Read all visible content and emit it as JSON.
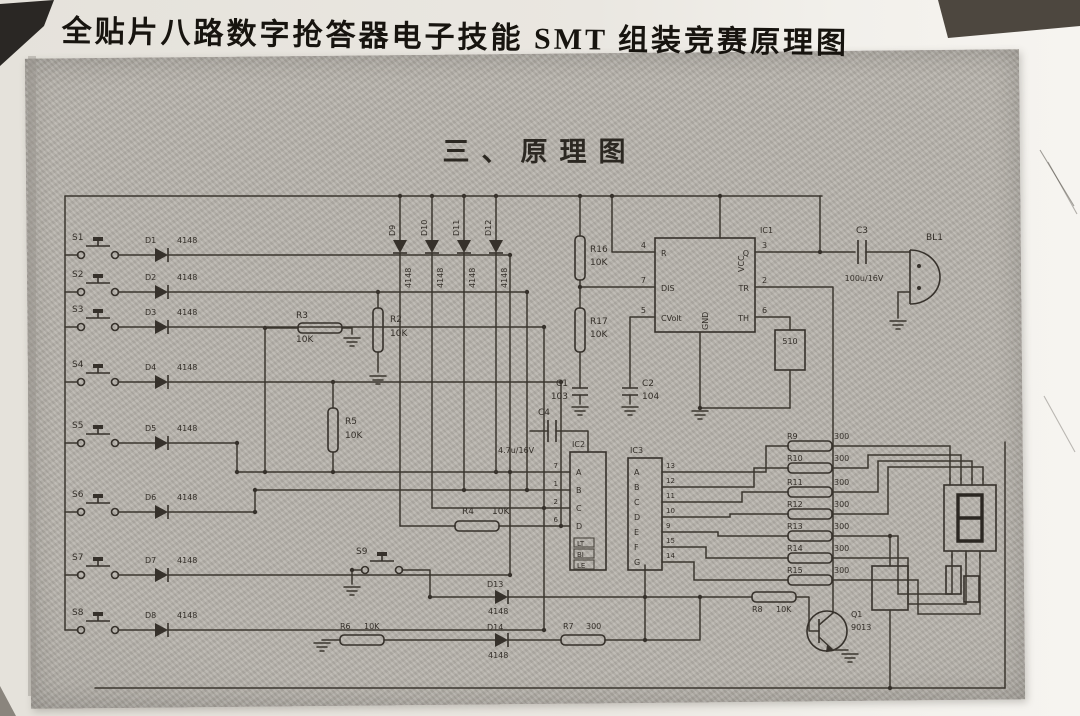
{
  "page": {
    "title": "全贴片八路数字抢答器电子技能 SMT 组装竞赛原理图",
    "heading": "三、原理图"
  },
  "schematic": {
    "channels": [
      {
        "sw": "S1",
        "d": "D1",
        "dv": "4148"
      },
      {
        "sw": "S2",
        "d": "D2",
        "dv": "4148"
      },
      {
        "sw": "S3",
        "d": "D3",
        "dv": "4148"
      },
      {
        "sw": "S4",
        "d": "D4",
        "dv": "4148"
      },
      {
        "sw": "S5",
        "d": "D5",
        "dv": "4148"
      },
      {
        "sw": "S6",
        "d": "D6",
        "dv": "4148"
      },
      {
        "sw": "S7",
        "d": "D7",
        "dv": "4148"
      },
      {
        "sw": "S8",
        "d": "D8",
        "dv": "4148"
      }
    ],
    "top_diodes": [
      {
        "ref": "D9",
        "val": "4148"
      },
      {
        "ref": "D10",
        "val": "4148"
      },
      {
        "ref": "D11",
        "val": "4148"
      },
      {
        "ref": "D12",
        "val": "4148"
      }
    ],
    "bottom_diodes": [
      {
        "ref": "D13",
        "val": "4148"
      },
      {
        "ref": "D14",
        "val": "4148"
      }
    ],
    "extra_switch": "S9",
    "resistors": {
      "r2": {
        "ref": "R2",
        "val": "10K"
      },
      "r3": {
        "ref": "R3",
        "val": "10K"
      },
      "r4": {
        "ref": "R4",
        "val": "10K"
      },
      "r5": {
        "ref": "R5",
        "val": "10K"
      },
      "r6": {
        "ref": "R6",
        "val": "10K"
      },
      "r7": {
        "ref": "R7",
        "val": "300"
      },
      "r8": {
        "ref": "R8",
        "val": "10K"
      },
      "r16": {
        "ref": "R16",
        "val": "10K"
      },
      "r17": {
        "ref": "R17",
        "val": "10K"
      },
      "r18": {
        "val": "510"
      }
    },
    "segment_resistors": [
      {
        "ref": "R9",
        "val": "300"
      },
      {
        "ref": "R10",
        "val": "300"
      },
      {
        "ref": "R11",
        "val": "300"
      },
      {
        "ref": "R12",
        "val": "300"
      },
      {
        "ref": "R13",
        "val": "300"
      },
      {
        "ref": "R14",
        "val": "300"
      },
      {
        "ref": "R15",
        "val": "300"
      }
    ],
    "capacitors": {
      "c1": {
        "ref": "C1",
        "val": "103"
      },
      "c2": {
        "ref": "C2",
        "val": "104"
      },
      "c3": {
        "ref": "C3",
        "val": "100u/16V"
      },
      "c4": {
        "ref": "C4",
        "val": "4.7u/16V"
      }
    },
    "transistor": {
      "ref": "Q1",
      "part": "9013"
    },
    "speaker": {
      "ref": "BL1"
    },
    "ic1": {
      "ref": "IC1",
      "pins_left": [
        {
          "n": "4",
          "name": "R"
        },
        {
          "n": "7",
          "name": "DIS"
        },
        {
          "n": "5",
          "name": "CVolt"
        }
      ],
      "pins_right": [
        {
          "n": "3",
          "name": "Q"
        },
        {
          "n": "2",
          "name": "TR"
        },
        {
          "n": "6",
          "name": "TH"
        }
      ],
      "top": "VCC",
      "bottom": "GND"
    },
    "ic2": {
      "ref": "IC2",
      "inputs": [
        "A",
        "B",
        "C",
        "D"
      ],
      "input_pins": [
        "7",
        "1",
        "2",
        "6"
      ],
      "controls": [
        "LT",
        "BI",
        "LE"
      ]
    },
    "ic3": {
      "ref": "IC3",
      "segs": [
        "A",
        "B",
        "C",
        "D",
        "E",
        "F",
        "G"
      ],
      "pins": [
        "13",
        "12",
        "11",
        "10",
        "9",
        "15",
        "14"
      ]
    }
  }
}
